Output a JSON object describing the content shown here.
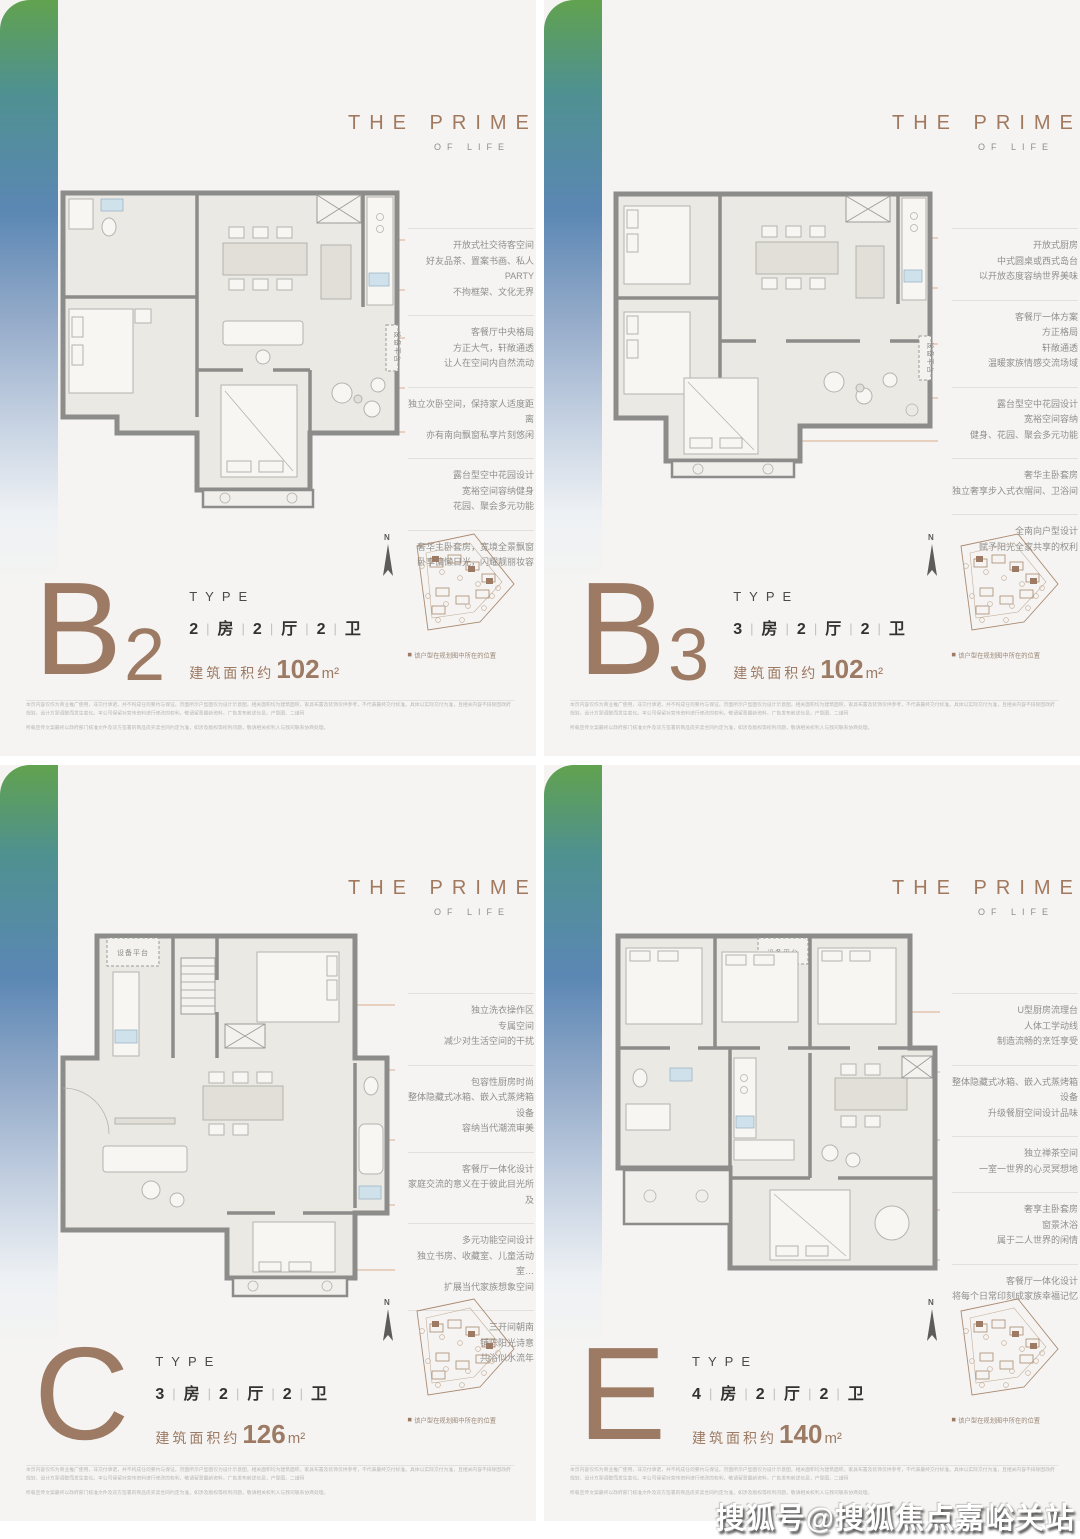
{
  "brand": {
    "line1": "THE PRIME",
    "line2": "OF LIFE"
  },
  "ui": {
    "separator": "|",
    "compass": "N",
    "sitemap_caption": "该户型在规划图中所在的位置",
    "equipment_label": "设备平台",
    "watermark": "搜狐号@搜狐焦点嘉峪关站"
  },
  "footer": {
    "line1": "本页内容仅作为商业推广使用，非交付承诺，并不构成任何要约与保证。页面所示户型图仅为设计示意图，相关面积均为建筑面积，家具布置及装饰仅供参考，不代表最终交付标准。具体以实际交付为准，且相关内容不排除因政府规划、设计方案调整而发生变化。本公司保留对宣传资料进行修改的权利，敬请留意最新资料，广告发布前述信息，户型图、二维码",
    "line2": "所载宣传文案最终以政府部门核准文件及双方签署的商品房买卖合同约定为准，如涉及版权等权利问题，敬请相关权利人与我司联系协商处理。"
  },
  "units": [
    {
      "letter": "B",
      "sub": "2",
      "type_label": "TYPE",
      "layout": [
        "2",
        "房",
        "2",
        "厅",
        "2",
        "卫"
      ],
      "area_prefix": "建筑面积约",
      "area_value": "102",
      "area_unit": "m²",
      "annotations": [
        [
          "开放式社交待客空间",
          "好友品茶、置案书画、私人PARTY",
          "不拘框架、文化无界"
        ],
        [
          "客餐厅中央格局",
          "方正大气，轩敞通透",
          "让人在空间内自然流动"
        ],
        [
          "独立次卧空间，保持家人适度距离",
          "亦有南向飘窗私享片刻悠闲"
        ],
        [
          "露台型空中花园设计",
          "宽裕空间容纳健身",
          "花园、聚会多元功能"
        ],
        [
          "奢华主卧套房，宽境全景飘窗",
          "卧享慵懒日光，闪耀靓丽妆容"
        ]
      ]
    },
    {
      "letter": "B",
      "sub": "3",
      "type_label": "TYPE",
      "layout": [
        "3",
        "房",
        "2",
        "厅",
        "2",
        "卫"
      ],
      "area_prefix": "建筑面积约",
      "area_value": "102",
      "area_unit": "m²",
      "annotations": [
        [
          "开放式厨房",
          "中式圆桌或西式岛台",
          "以开放态度容纳世界美味"
        ],
        [
          "客餐厅一体方案",
          "方正格局",
          "轩敞通透",
          "温暖家族情感交流场域"
        ],
        [
          "露台型空中花园设计",
          "宽裕空间容纳",
          "健身、花园、聚会多元功能"
        ],
        [
          "奢华主卧套房",
          "独立奢享步入式衣帽间、卫浴间"
        ],
        [
          "全南向户型设计",
          "赋予阳光全家共享的权利"
        ]
      ]
    },
    {
      "letter": "C",
      "sub": "",
      "type_label": "TYPE",
      "layout": [
        "3",
        "房",
        "2",
        "厅",
        "2",
        "卫"
      ],
      "area_prefix": "建筑面积约",
      "area_value": "126",
      "area_unit": "m²",
      "annotations": [
        [
          "独立洗衣操作区",
          "专属空间",
          "减少对生活空间的干扰"
        ],
        [
          "包容性厨房时尚",
          "整体隐藏式冰箱、嵌入式蒸烤箱设备",
          "容纳当代潮流审美"
        ],
        [
          "客餐厅一体化设计",
          "家庭交流的意义在于彼此目光所及"
        ],
        [
          "多元功能空间设计",
          "独立书房、收藏室、儿童活动室…",
          "扩展当代家族想象空间"
        ],
        [
          "三开间朝南",
          "铺陈阳光诗意",
          "共浴似水流年"
        ]
      ]
    },
    {
      "letter": "E",
      "sub": "",
      "type_label": "TYPE",
      "layout": [
        "4",
        "房",
        "2",
        "厅",
        "2",
        "卫"
      ],
      "area_prefix": "建筑面积约",
      "area_value": "140",
      "area_unit": "m²",
      "annotations": [
        [
          "U型厨房流理台",
          "人体工学动线",
          "制造流畅的烹饪享受"
        ],
        [
          "整体隐藏式冰箱、嵌入式蒸烤箱设备",
          "升级餐厨空间设计品味"
        ],
        [
          "独立禅茶空间",
          "一室一世界的心灵冥想地"
        ],
        [
          "奢享主卧套房",
          "窗景沐浴",
          "属于二人世界的闲情"
        ],
        [
          "客餐厅一体化设计",
          "将每个日常印刻成家族幸福记忆"
        ]
      ]
    }
  ]
}
